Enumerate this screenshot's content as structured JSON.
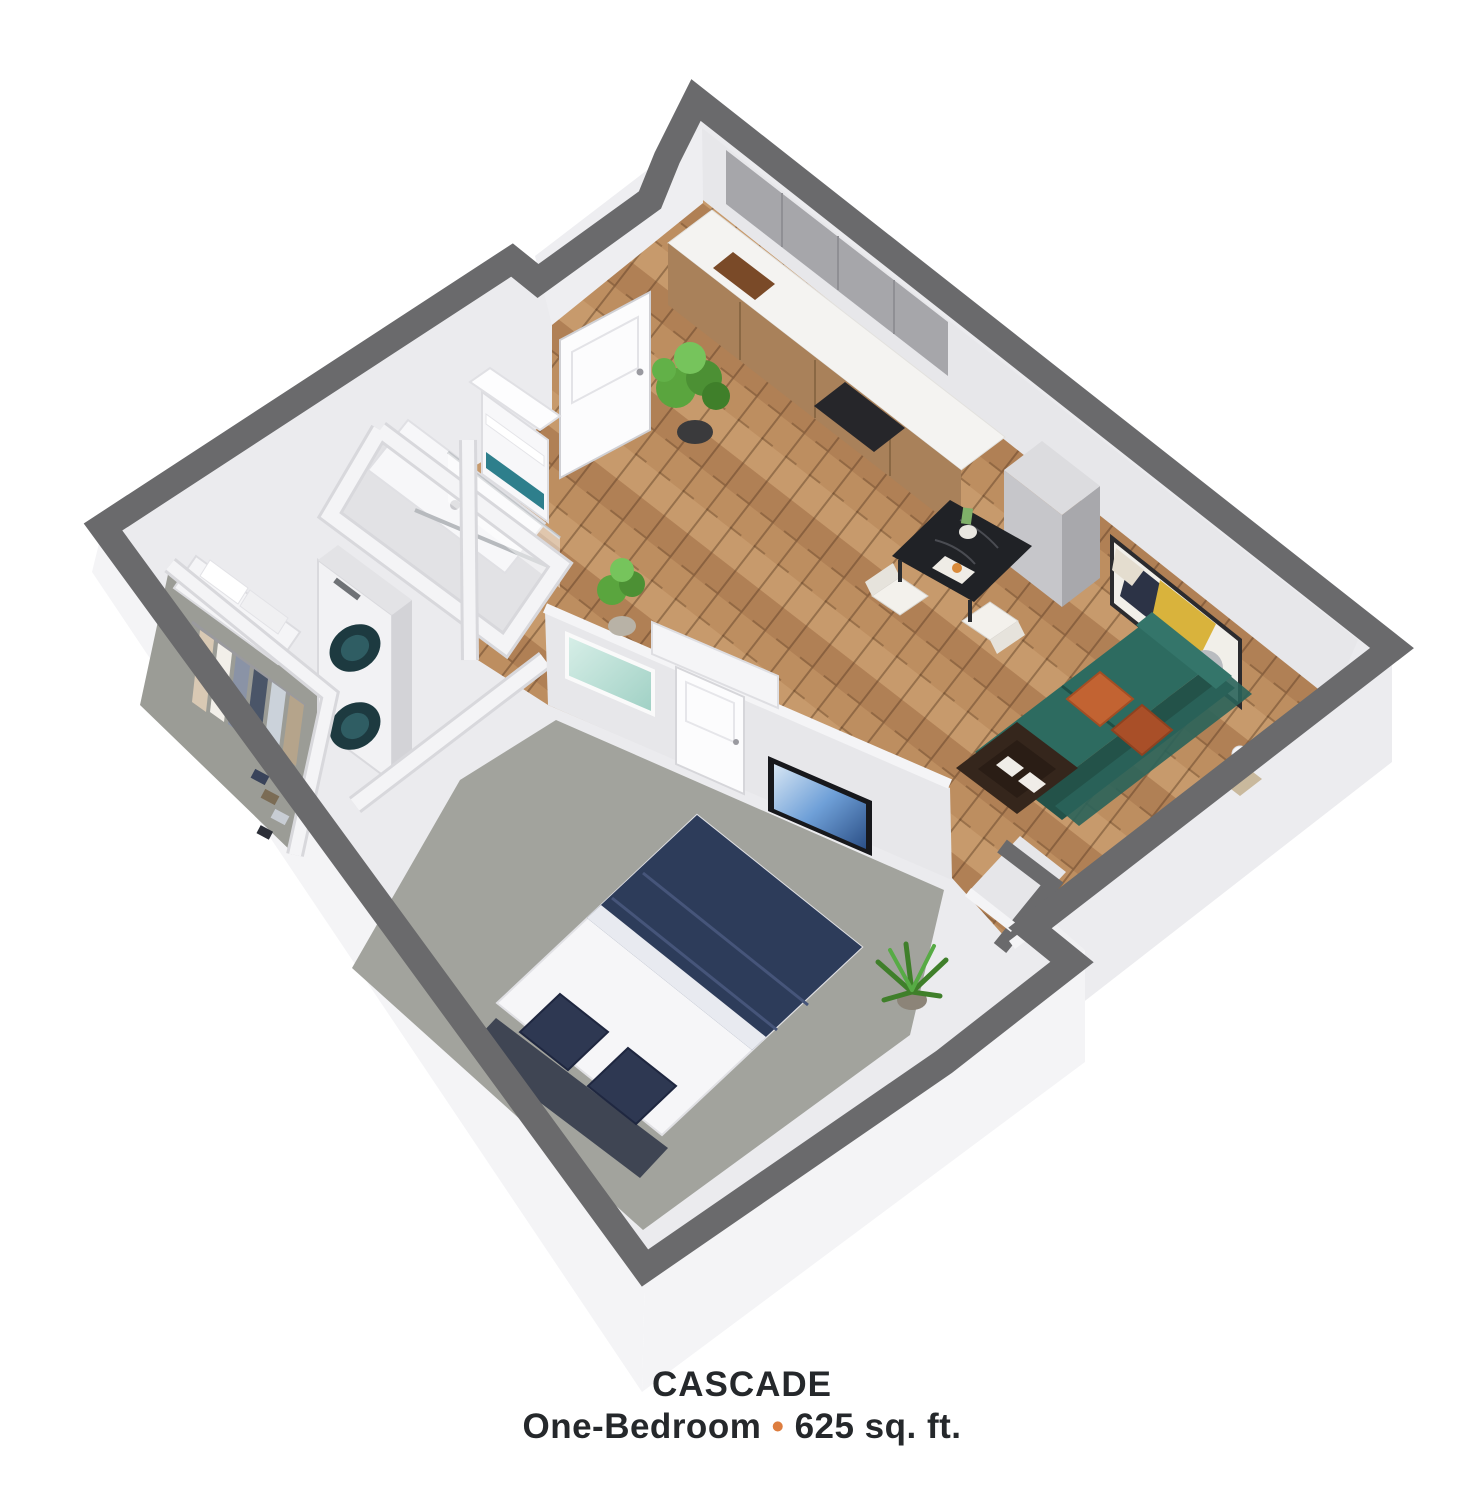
{
  "plan": {
    "title": "CASCADE",
    "subtitle": {
      "type_label": "One-Bedroom",
      "separator": "•",
      "area_label": "625 sq. ft."
    }
  },
  "palette": {
    "cap": "#6a6a6c",
    "wallBase": "#ebebee",
    "wallFace": "#e7e7ea",
    "wallWhite": "#f5f5f7",
    "extFace": "#f4f4f6",
    "extFaceDark": "#ececef",
    "wood": "#bd8e60",
    "woodDark": "#8a5f3c",
    "carpet": "#a2a39d",
    "carpetCloset": "#9b9c96",
    "bathFloor": "#e2e2e5",
    "sofa": "#2d6b60",
    "sofaDark": "#235249",
    "pillowOrange": "#c26332",
    "pillowOrangeDark": "#a94f28",
    "navy": "#2d3c5a",
    "navyDark": "#3f4553",
    "pillowNavy": "#2e3852",
    "marble": "#202226",
    "artYellow": "#d9b33c",
    "artNavy": "#2c3346",
    "seafoam": "#9fd0c4",
    "tvBlue": "#6fa0d8",
    "towelTeal": "#2e7f8c",
    "plantGreen": "#5aa53e",
    "plantDark": "#3f7f2a",
    "cabinetGray": "#a6a6aa",
    "counterWhite": "#f4f3f1",
    "accent": "#dd7d3f",
    "text": "#25282b"
  },
  "objects": {
    "kitchen": [
      "upper-cabinets",
      "counter",
      "cooktop",
      "fridge-cabinet"
    ],
    "dining": [
      "dining-table",
      "dining-chair",
      "dining-chair"
    ],
    "living": [
      "sofa",
      "throw-pillows",
      "coffee-table",
      "side-table",
      "wall-art"
    ],
    "bedroom": [
      "bed",
      "headboard",
      "pillows",
      "duvet",
      "tv",
      "bedroom-door",
      "bedroom-art",
      "palm-plant"
    ],
    "bathroom": [
      "shower",
      "grab-bar",
      "towel-shelf"
    ],
    "utility": [
      "stacked-washer-dryer",
      "closet-shelf",
      "hanging-clothes"
    ],
    "entry": [
      "front-door",
      "entry-plant",
      "hall-plant",
      "hall-bench"
    ]
  }
}
